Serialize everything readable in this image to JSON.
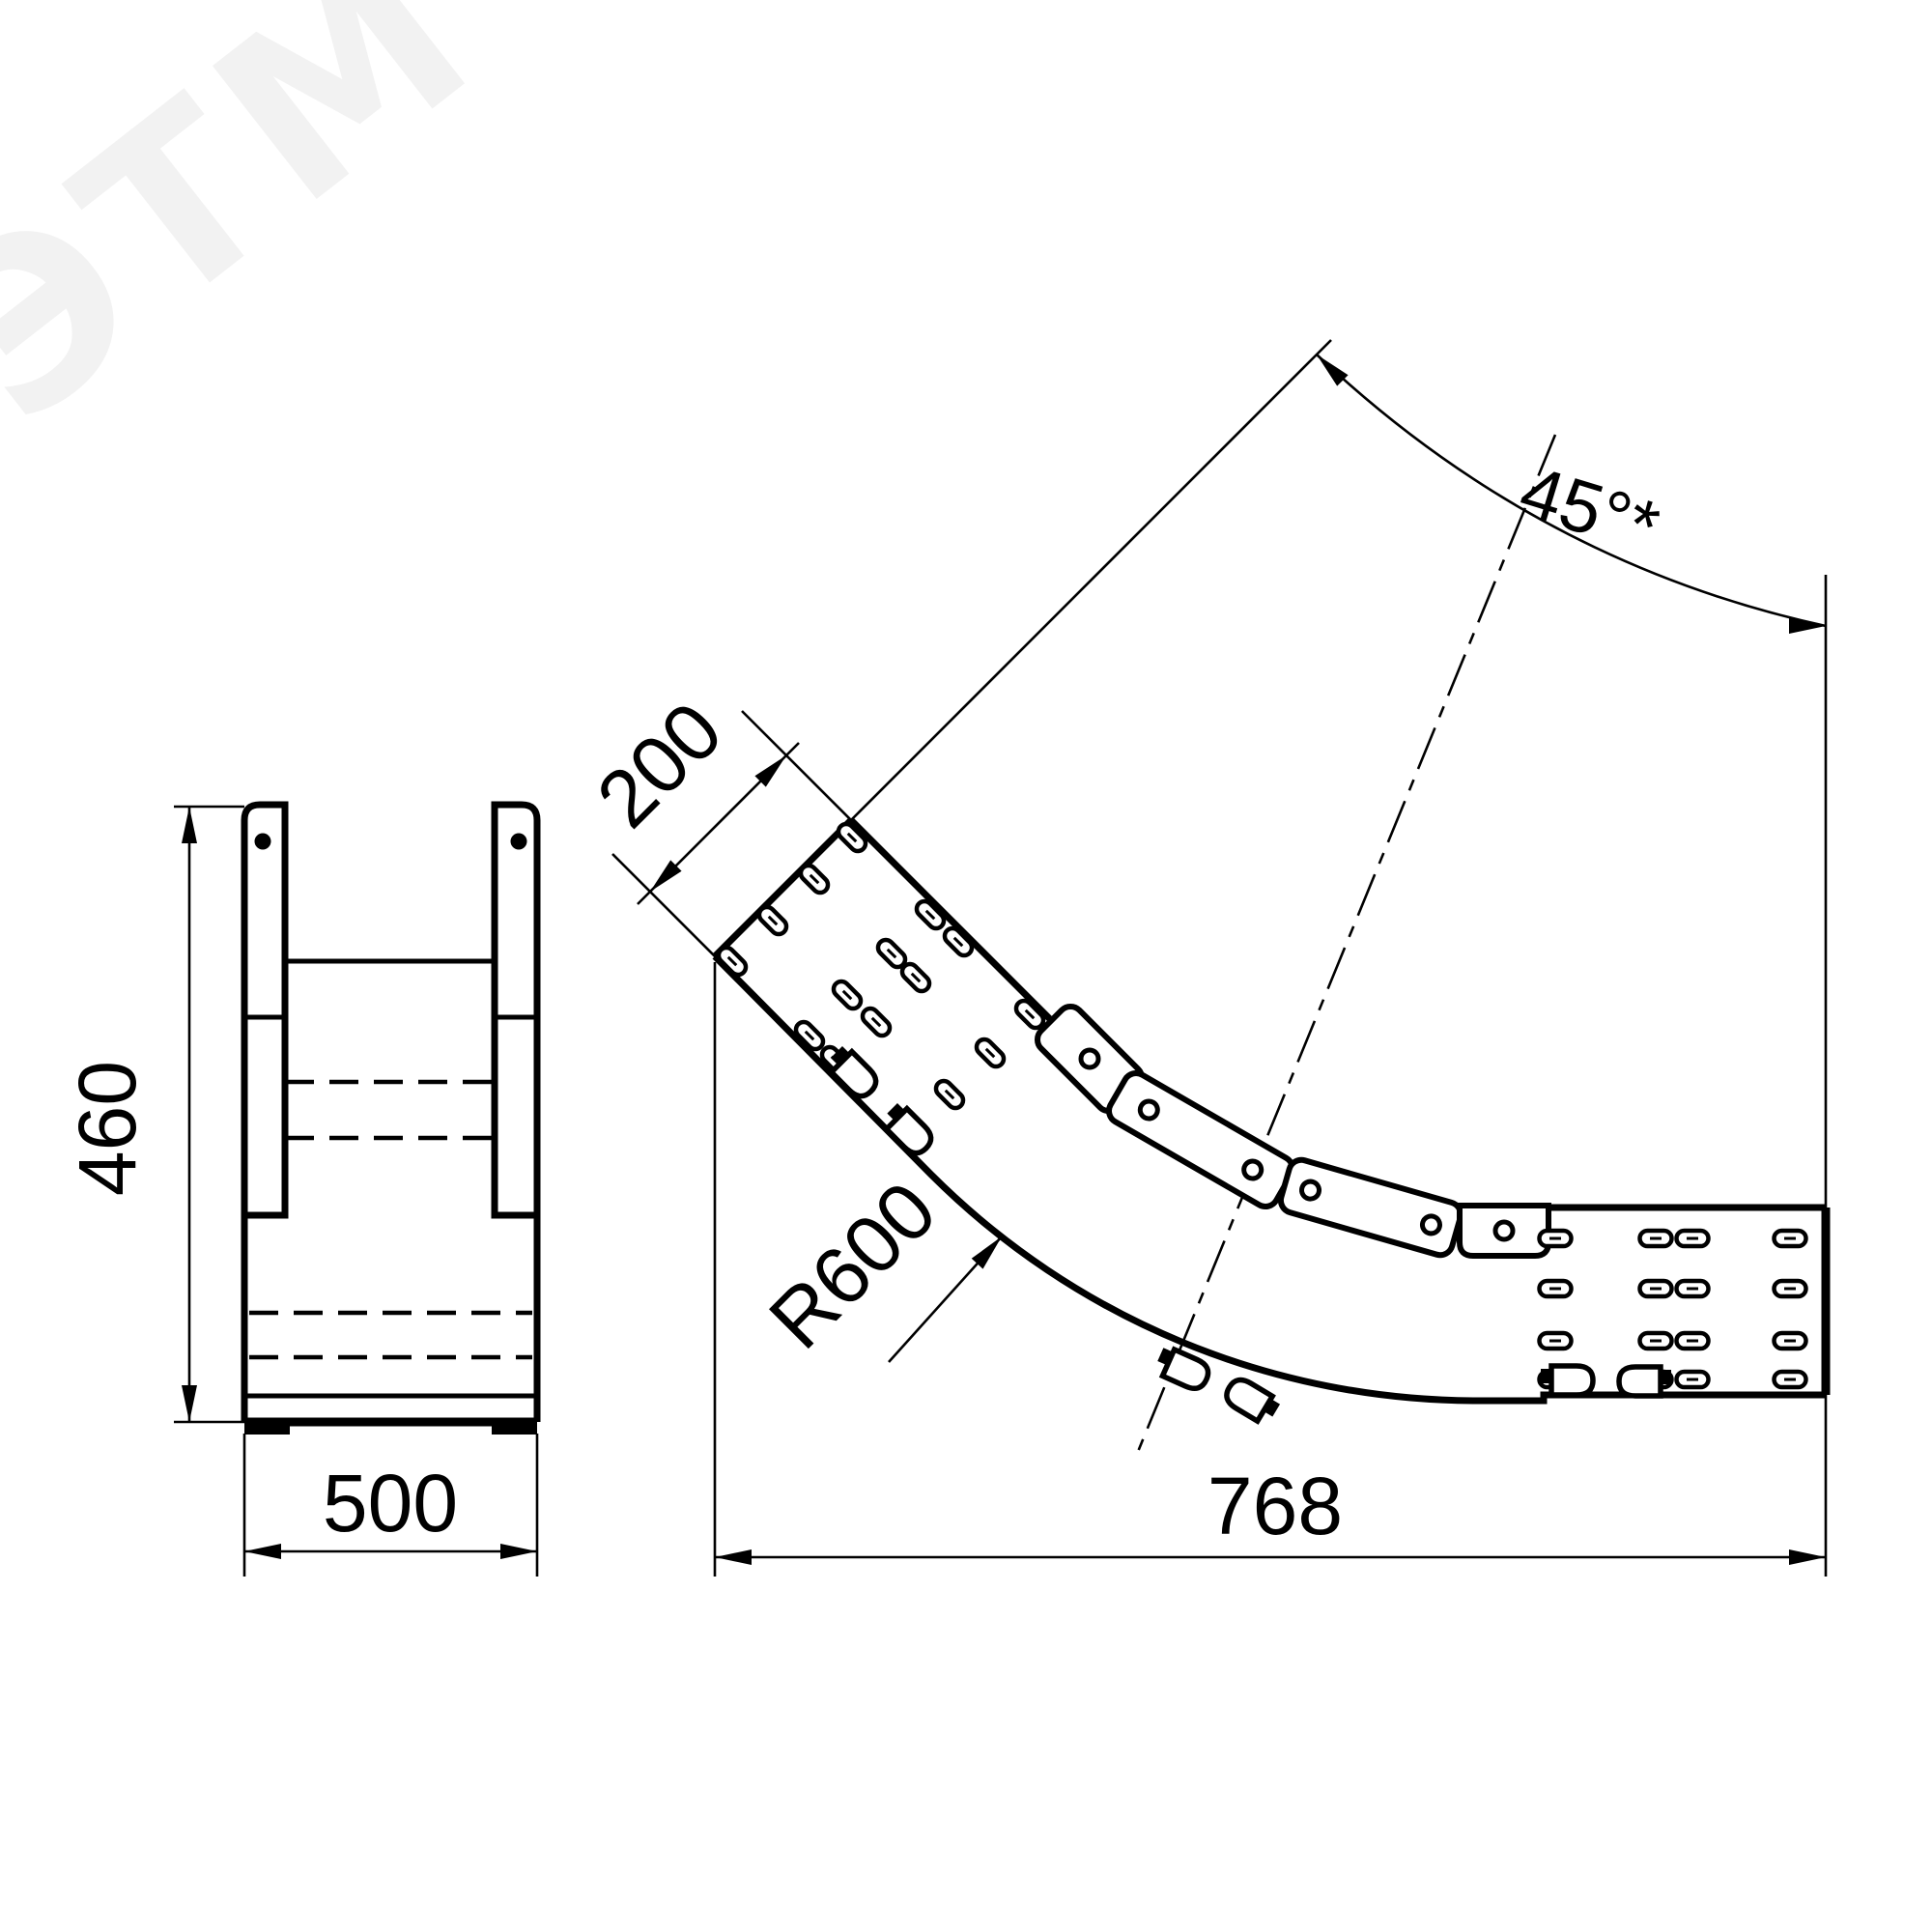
{
  "colors": {
    "line": "#000000",
    "background": "#ffffff",
    "watermark": "#f2f2f2"
  },
  "watermark": {
    "text": "ЭТМ"
  },
  "drawing": {
    "type": "technical-dimension-drawing",
    "views": [
      "front-section-view",
      "bend-plan-view"
    ]
  },
  "front_view": {
    "dim_height": "460",
    "dim_width": "500"
  },
  "bend_view": {
    "dim_tray_width": "200",
    "dim_radius": "R600",
    "dim_length": "768",
    "dim_angle": "45°*"
  }
}
